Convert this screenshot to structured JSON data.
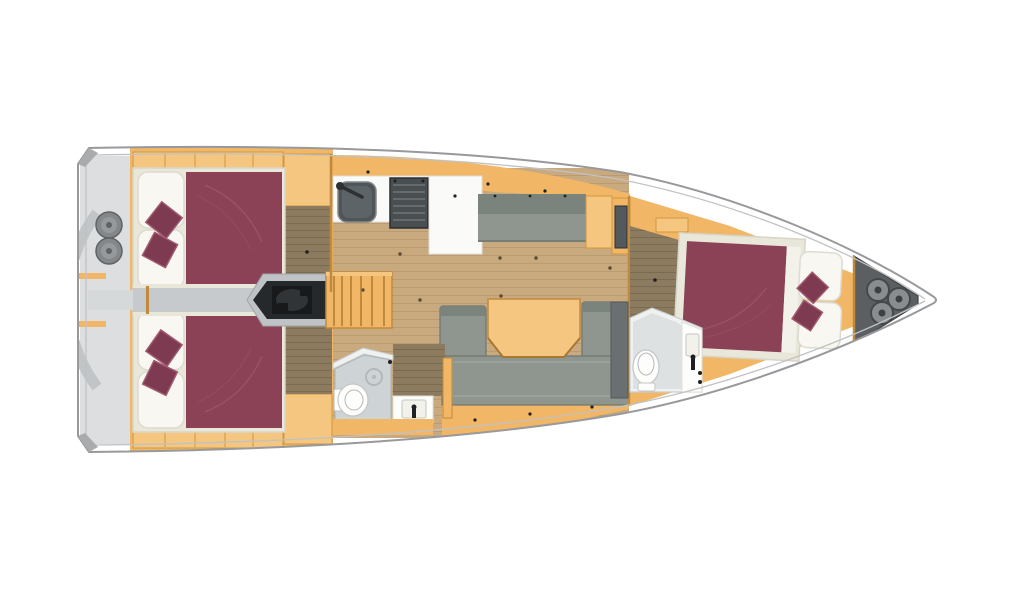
{
  "diagram": {
    "kind": "sailing-yacht-interior-floor-plan",
    "view": "top-down",
    "bow_direction": "right",
    "cabins_count": "3",
    "bathrooms_count": "2",
    "deck_hatches_count": "3",
    "stern_winches_count": "2"
  },
  "areas": [
    {
      "id": "hull",
      "label": "Yacht hull, top view, bow to the right"
    },
    {
      "id": "stern",
      "label": "Stern swim platform"
    },
    {
      "id": "winches",
      "label": "Two stern winches"
    },
    {
      "id": "aft-cabin-port",
      "label": "Aft double cabin (port) with maroon bedspread and two cushions"
    },
    {
      "id": "aft-cabin-starboard",
      "label": "Aft double cabin (starboard) with maroon bedspread and two cushions"
    },
    {
      "id": "corridor",
      "label": "Aft corridor between cabins"
    },
    {
      "id": "engine",
      "label": "Engine compartment under companionway"
    },
    {
      "id": "stairs",
      "label": "Companionway steps"
    },
    {
      "id": "galley",
      "label": "Galley with sink and stove"
    },
    {
      "id": "salon",
      "label": "Salon with wooden floor"
    },
    {
      "id": "settee",
      "label": "Straight settee on port side"
    },
    {
      "id": "dinette",
      "label": "U-shaped settee with folding table"
    },
    {
      "id": "aft-head",
      "label": "Aft bathroom with toilet, shower drain and washbasin"
    },
    {
      "id": "fwd-cabin",
      "label": "Forward owner cabin with double bed"
    },
    {
      "id": "fwd-head",
      "label": "Forward bathroom with toilet and washbasin"
    },
    {
      "id": "bow-locker",
      "label": "Bow anchor locker with three round hatches"
    }
  ],
  "colors": {
    "page": "#ffffff",
    "hull": "#fcfcfc",
    "hull_line": "#97999c",
    "rim_line": "#c0c2c4",
    "corner": "#a9abad",
    "deck": "#dcdedf",
    "deck_dark": "#c2c5c7",
    "corridor": "#c6cacc",
    "corridor_light": "#d6d9da",
    "winch": "#83878a",
    "winch_dark": "#5f6366",
    "winch_light": "#96999c",
    "wood": "#f1b766",
    "wood_light": "#f5c67f",
    "wood_edge": "#d2973f",
    "wood_line": "#c08a3e",
    "wood_deep": "#a87832",
    "floor": "#c9a97e",
    "floor_dark": "#8d7b5f",
    "plank": "#6e5433",
    "maroon": "#8b4156",
    "maroon_cushion": "#7d3a50",
    "maroon_hi": "#a05a70",
    "linen": "#e9e7da",
    "linen_edge": "#d8d5c8",
    "pillow": "#f8f7f2",
    "pillow_edge": "#dedbd0",
    "white_trim": "#f2f1ea",
    "sofa": "#8e968f",
    "sofa_dark": "#7b837d",
    "sofa_edge": "#6e766f",
    "sofa_light": "#99a19a",
    "counter": "#fafaf8",
    "counter_edge": "#e0ded8",
    "head_wall": "#f0f2f1",
    "head_wall_edge": "#c8cbcc",
    "head_floor": "#ced3d5",
    "head_floor_edge": "#b4b8ba",
    "fixture": "#fdfdfc",
    "fixture_edge": "#c3c6c7",
    "steel": "#4f5558",
    "steel_mid": "#5d6467",
    "steel_edge": "#83888b",
    "stove": "#494e51",
    "stove_edge": "#2c2f31",
    "stove_grate": "#6d7477",
    "panel": "#54595c",
    "panel_edge": "#2e3134",
    "engine_pocket": "#bfc3c5",
    "engine_pocket_edge": "#9fa3a5",
    "engine": "#26292c",
    "engine_dark": "#17191b",
    "engine_mid": "#303437",
    "locker": "#5b5f62",
    "locker_edge": "#3f4346",
    "hatch": "#898d90",
    "hatch_edge": "#44484b",
    "hatch_dot": "#3c4043",
    "shower_col": "#6a6f72",
    "shower_col_edge": "#54585b",
    "dot": "#4a3a26",
    "hardware": "#1e2022"
  }
}
